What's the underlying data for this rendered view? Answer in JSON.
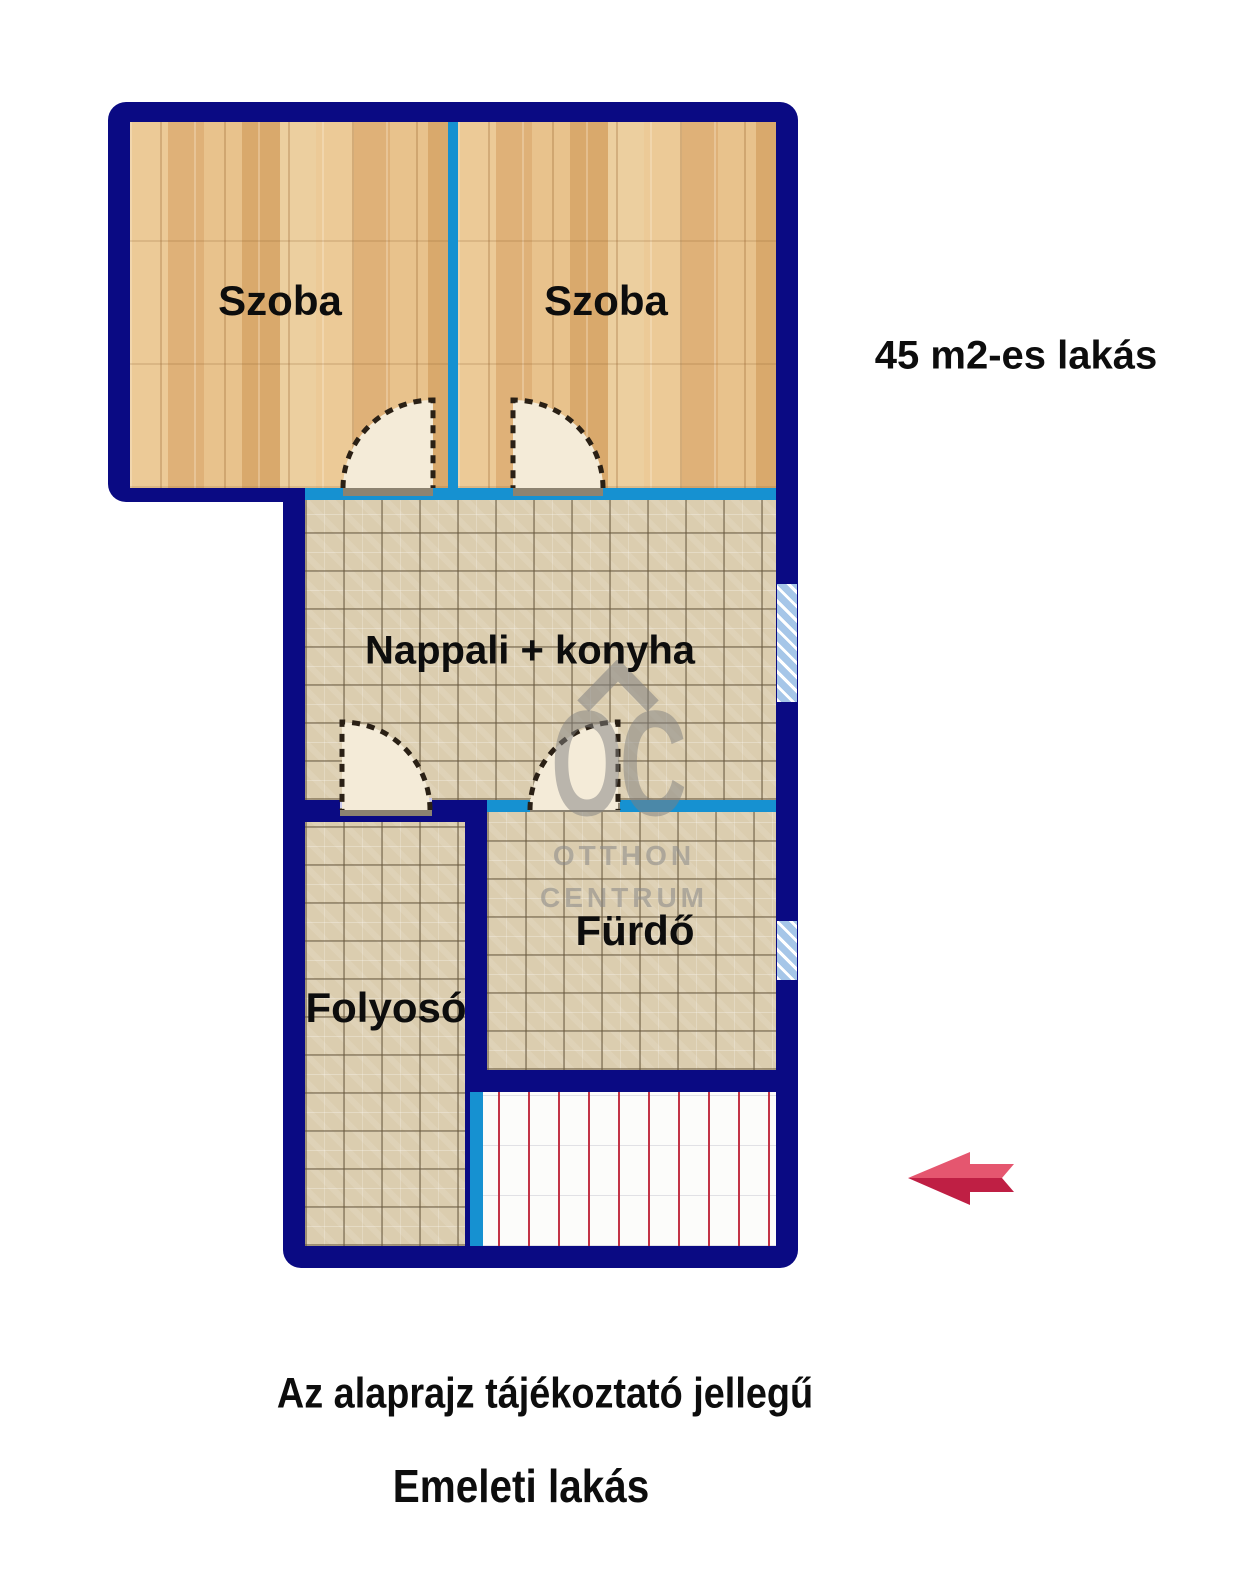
{
  "plan": {
    "area_title": "45 m2-es lakás",
    "rooms": {
      "szoba_left": "Szoba",
      "szoba_right": "Szoba",
      "nappali": "Nappali + konyha",
      "furdo": "Fürdő",
      "folyoso": "Folyosó"
    },
    "colors": {
      "wall_outer": "#0a0a83",
      "wall_inner": "#1691d1",
      "wood_floor": "#e2bb83",
      "tile_floor": "#dbcdaf",
      "window_glass": "#a6c6e8",
      "stairs_line": "#c23447",
      "arrow_light": "#e5566f",
      "arrow_dark": "#bf1f44"
    }
  },
  "watermark": {
    "logo": "OC",
    "line1": "OTTHON",
    "line2": "CENTRUM"
  },
  "footer": {
    "disclaimer": "Az alaprajz tájékoztató jellegű",
    "floor_label": "Emeleti lakás"
  }
}
